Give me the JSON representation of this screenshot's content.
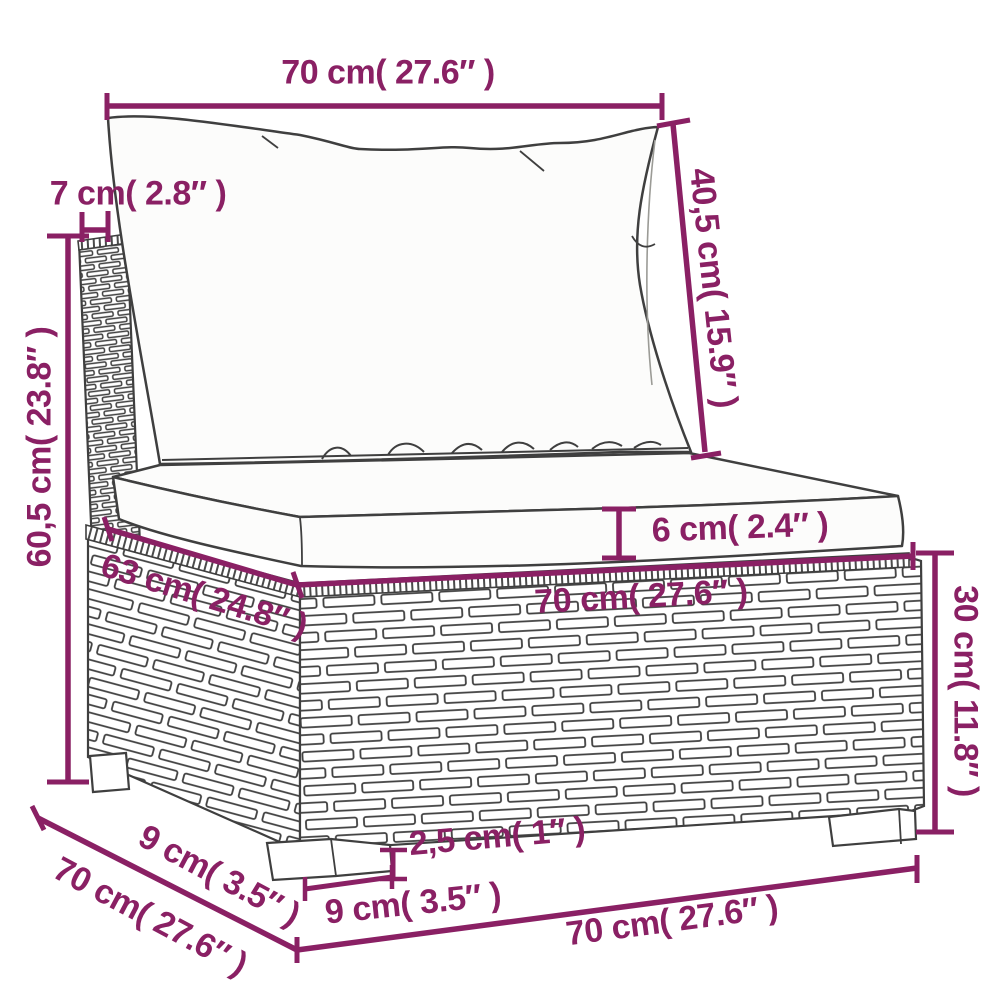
{
  "figure": {
    "type": "furniture-dimension-diagram",
    "subject": "rattan garden sofa middle section with back and seat cushions",
    "units": "cm / inches"
  },
  "colors": {
    "dimension": "#8a2064",
    "line_art": "#3f3f3f",
    "cushion_fill": "#fcfcfb",
    "background": "#ffffff"
  },
  "dimensions": {
    "top_width": {
      "label": "70 cm( 27.6″ )"
    },
    "back_height": {
      "label": "40,5 cm( 15.9″ )"
    },
    "post_width": {
      "label": "7 cm( 2.8″ )"
    },
    "total_height": {
      "label": "60,5 cm( 23.8″ )"
    },
    "cushion_thickness": {
      "label": "6 cm( 2.4″ )"
    },
    "seat_depth": {
      "label": "63 cm( 24.8″ )"
    },
    "seat_width": {
      "label": "70 cm( 27.6″ )"
    },
    "base_height": {
      "label": "30 cm( 11.8″ )"
    },
    "foot_height": {
      "label": "2,5 cm( 1″ )"
    },
    "foot_offset_depth": {
      "label": "9 cm( 3.5″ )"
    },
    "total_depth": {
      "label": "70 cm( 27.6″ )"
    },
    "foot_width": {
      "label": "9 cm( 3.5″ )"
    },
    "total_width": {
      "label": "70 cm( 27.6″ )"
    }
  }
}
